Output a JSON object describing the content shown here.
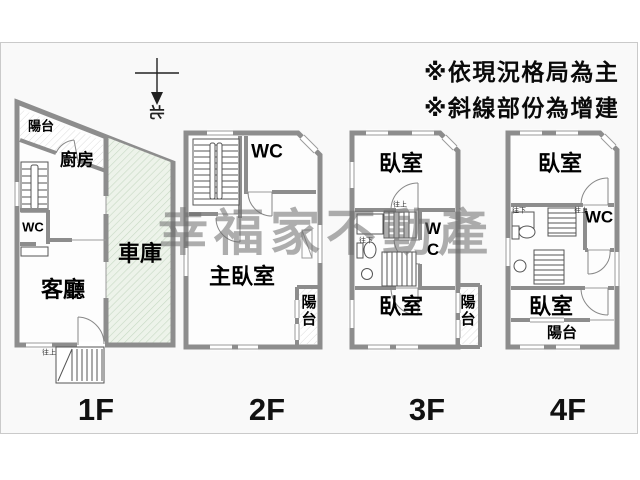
{
  "notes": {
    "line1": "※依現況格局為主",
    "line2": "※斜線部份為增建"
  },
  "watermark": {
    "text": "幸福家不動產"
  },
  "compass": {
    "north_label": "北"
  },
  "floor_labels": {
    "f1": "1F",
    "f2": "2F",
    "f3": "3F",
    "f4": "4F"
  },
  "floor1": {
    "balcony": "陽台",
    "kitchen": "廚房",
    "wc": "WC",
    "living": "客廳",
    "garage": "車庫",
    "stair_up": "往上"
  },
  "floor2": {
    "wc": "WC",
    "master_bedroom": "主臥室",
    "balcony": "陽台"
  },
  "floor3": {
    "bedroom_top": "臥室",
    "wc": "WC",
    "bedroom_bottom": "臥室",
    "balcony": "陽台",
    "stair_up": "往上",
    "stair_down": "往下"
  },
  "floor4": {
    "bedroom_top": "臥室",
    "wc": "WC",
    "bedroom_bottom": "臥室",
    "balcony": "陽台",
    "stair_up": "往上",
    "stair_down": "往下"
  },
  "colors": {
    "wall": "#8d8d8d",
    "thin_line": "#666666",
    "window_line": "#9a9a9a",
    "garage_fill": "#edf3ea",
    "garage_hatch": "#c7d9c4",
    "balcony_hatch": "#dcdcdc",
    "floor_fill": "#fdfdfd",
    "panel_bg": "#f9f9f9",
    "panel_border": "#cacaca",
    "watermark": "#6c6c6c"
  }
}
